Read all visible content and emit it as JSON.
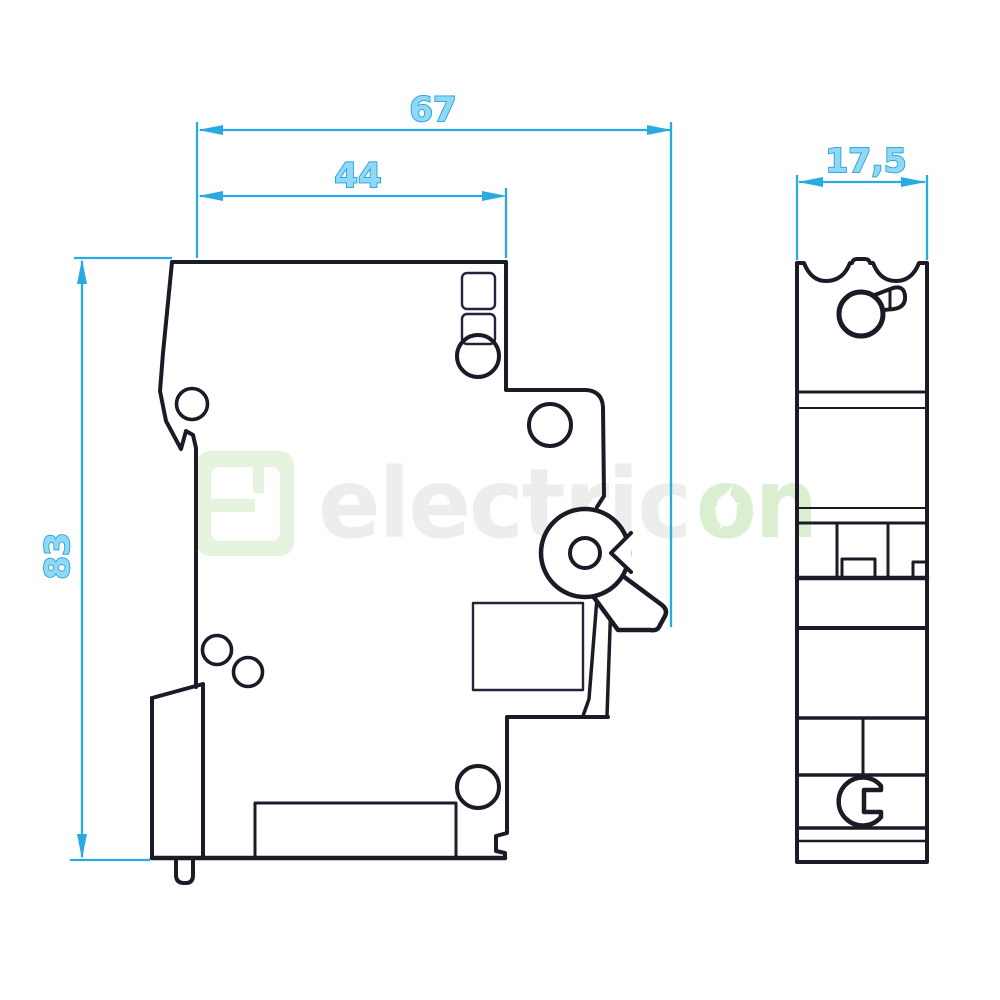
{
  "drawing": {
    "type": "technical dimension drawing of a 1-pole miniature circuit breaker",
    "views": {
      "side_view": "side profile view",
      "front_view": "narrow front (end) view"
    }
  },
  "dimensions": {
    "total_depth": {
      "label": "67"
    },
    "body_depth": {
      "label": "44"
    },
    "total_height": {
      "label": "83"
    },
    "module_width": {
      "label": "17,5"
    }
  },
  "watermark": {
    "text": "electricon",
    "text_gray": "electric",
    "text_green": "on"
  },
  "colors": {
    "dimension_stroke": "#1B9DD9",
    "dimension_line": "#29ABE2",
    "dimension_fill": "#8FD9F7",
    "drawing_line": "#1b1b28",
    "watermark_green": "#dcf0d2",
    "watermark_gray": "#ebeeea",
    "background": "#ffffff"
  }
}
